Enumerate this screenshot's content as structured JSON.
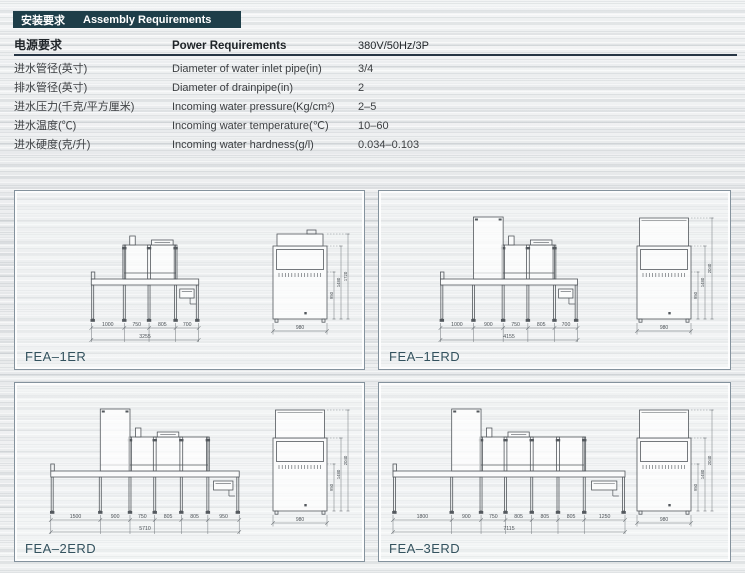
{
  "header": {
    "zh": "安装要求",
    "en": "Assembly Requirements",
    "bg_color": "#1e3e49",
    "text_color": "#ffffff"
  },
  "table": {
    "head": {
      "zh": "电源要求",
      "en": "Power Requirements",
      "value": "380V/50Hz/3P"
    },
    "rows": [
      {
        "zh": "进水管径(英寸)",
        "en": "Diameter of water inlet pipe(in)",
        "value": "3/4"
      },
      {
        "zh": "排水管径(英寸)",
        "en": "Diameter of drainpipe(in)",
        "value": "2"
      },
      {
        "zh": "进水压力(千克/平方厘米)",
        "en": "Incoming water pressure(Kg/cm²)",
        "value": "2–5"
      },
      {
        "zh": "进水温度(℃)",
        "en": "Incoming water temperature(℃)",
        "value": "10–60"
      },
      {
        "zh": "进水硬度(克/升)",
        "en": "Incoming water hardness(g/l)",
        "value": "0.034–0.103"
      }
    ]
  },
  "diagrams": [
    {
      "model": "FEA–1ER",
      "type": "ER",
      "segments": [
        1000,
        750,
        805,
        700
      ],
      "segment_labels": [
        "1000",
        "750",
        "805",
        "700"
      ],
      "total_label": "3255",
      "end_view": {
        "width_label": "980",
        "height_labels": [
          "950",
          "1480",
          "1720"
        ]
      }
    },
    {
      "model": "FEA–1ERD",
      "type": "ERD",
      "segments": [
        1000,
        900,
        750,
        805,
        700
      ],
      "segment_labels": [
        "1000",
        "900",
        "750",
        "805",
        "700"
      ],
      "total_label": "4155",
      "end_view": {
        "width_label": "980",
        "height_labels": [
          "950",
          "1480",
          "2040"
        ]
      }
    },
    {
      "model": "FEA–2ERD",
      "type": "ERD",
      "segments": [
        1500,
        900,
        750,
        805,
        805,
        950
      ],
      "segment_labels": [
        "1500",
        "900",
        "750",
        "805",
        "805",
        "950"
      ],
      "total_label": "5710",
      "end_view": {
        "width_label": "980",
        "height_labels": [
          "950",
          "1480",
          "2040"
        ]
      }
    },
    {
      "model": "FEA–3ERD",
      "type": "ERD",
      "segments": [
        1800,
        900,
        750,
        805,
        805,
        805,
        1250
      ],
      "segment_labels": [
        "1800",
        "900",
        "750",
        "805",
        "805",
        "805",
        "1250"
      ],
      "total_label": "7115",
      "end_view": {
        "width_label": "980",
        "height_labels": [
          "950",
          "1480",
          "2040"
        ]
      }
    }
  ]
}
